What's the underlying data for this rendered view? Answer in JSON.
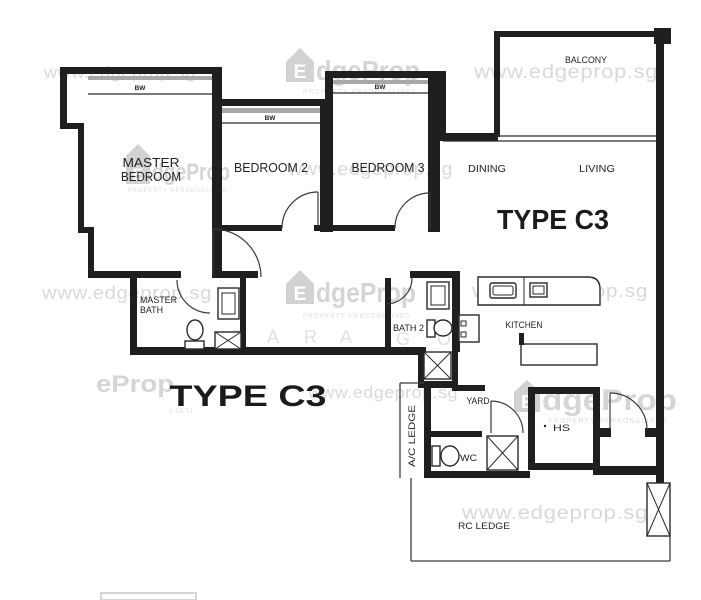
{
  "figure_type": "floor_plan",
  "unit": {
    "type_label": "TYPE C3"
  },
  "rooms": {
    "master_bedroom": [
      "MASTER",
      "BEDROOM"
    ],
    "bedroom2": "BEDROOM 2",
    "bedroom3": "BEDROOM 3",
    "dining": "DINING",
    "living": "LIVING",
    "balcony": "BALCONY",
    "master_bath": [
      "MASTER",
      "BATH"
    ],
    "bath2": "BATH 2",
    "kitchen": "KITCHEN",
    "yard": "YARD",
    "wc": "WC",
    "hs": "HS",
    "ac_ledge": "A/C LEDGE",
    "rc_ledge": "RC LEDGE",
    "bay_window": "BW"
  },
  "watermarks": {
    "url": "www.edgeprop.sg",
    "logo_e": "E",
    "logo_rest": "dgeProp",
    "logo_rest_partial": "eProp",
    "tagline": "PROPERTY PERSONALISED",
    "tagline_partial": "LISTI",
    "letters": [
      "S",
      "A",
      "R",
      "A",
      "G",
      "O"
    ]
  },
  "colors": {
    "background": "#ffffff",
    "wall": "#1f1f1f",
    "bay_band": "#a8a8a8",
    "label": "#232323",
    "watermark": "#d9d9d9"
  }
}
